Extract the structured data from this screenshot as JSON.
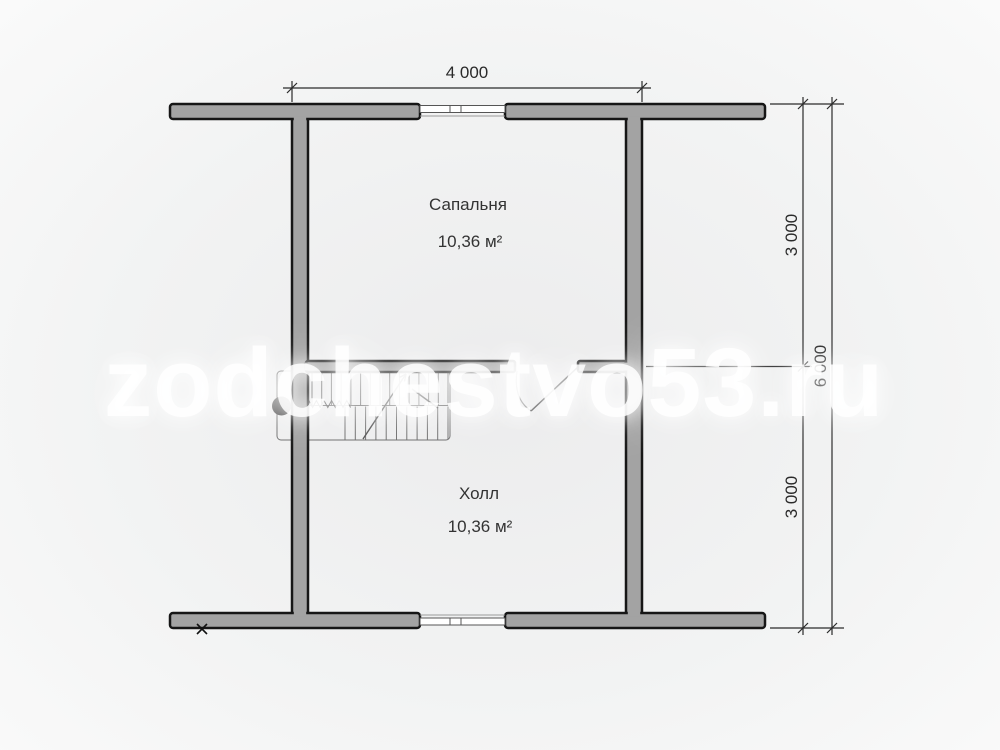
{
  "watermark": {
    "text": "zodchestvo53.ru"
  },
  "floor_plan": {
    "rooms": [
      {
        "name": "Сапальня",
        "area": "10,36 м²"
      },
      {
        "name": "Холл",
        "area": "10,36 м²"
      }
    ],
    "dimensions": {
      "width_top": "4 000",
      "right_upper_segment": "3 000",
      "right_lower_segment": "3 000",
      "right_total": "6 000"
    },
    "icons": {
      "staircase": "u-shaped-stair-with-up-arrow",
      "door": "door-swing-arc",
      "windows": "double-line-window-symbol",
      "corner_marker": "x-cross"
    },
    "colors": {
      "wall_fill": "#a3a3a3",
      "wall_stroke": "#161616",
      "dimension_line": "#2a2a2a",
      "stair_line": "#6e6e6e",
      "text": "#333333",
      "background": "#f2f3f3"
    }
  }
}
